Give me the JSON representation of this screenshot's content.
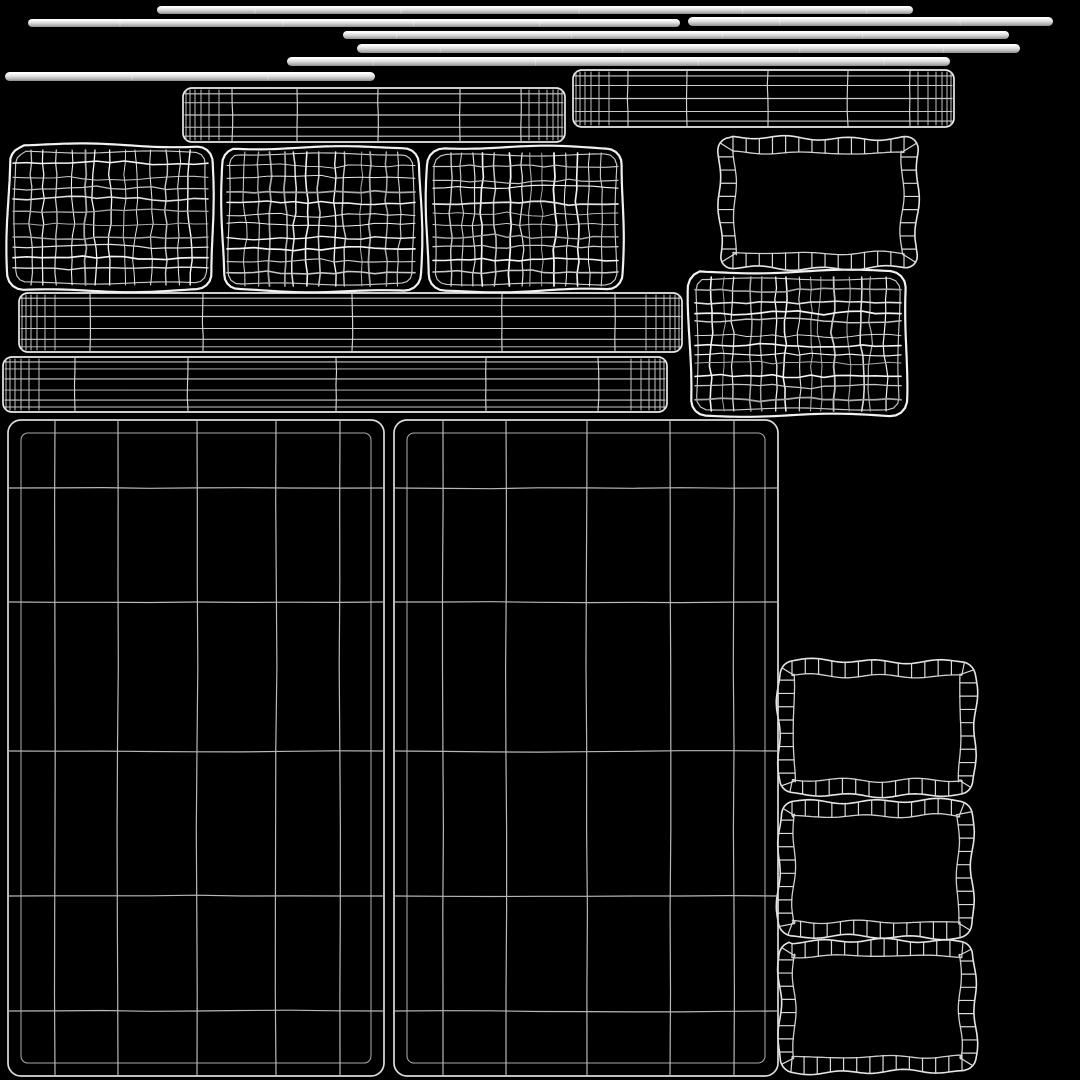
{
  "meta": {
    "description": "UV wireframe layout sheet of upholstered furniture parts rendered as white mesh islands on black",
    "background": "#000000",
    "canvas": {
      "width": 1080,
      "height": 1080
    }
  },
  "palette": {
    "edge": "#f1f1f1",
    "inner_edge": "#c9c9c9",
    "grid_levels": [
      "#a8a8a8",
      "#c6c6c6",
      "#e0e0e0",
      "#f4f4f4"
    ],
    "tube_outline": "#eaeaea",
    "tube_hline": "#c9c9c9",
    "tube_vline": "#d4d4d4",
    "tube_dense": "#c2c2c2",
    "panel_outline": "#dcdcdc",
    "panel_inner": "#a9a9a9",
    "panel_line": "#b8b8b8",
    "ladder_outer": "#e6e6e6",
    "ladder_inner": "#cfcfcf",
    "ladder_rung": "#dadada",
    "rod_top": "#ffffff",
    "rod_mid": "#e6e6e6",
    "rod_low": "#b4b4b4",
    "rod_bottom": "#8d8d8d"
  },
  "islands": [
    {
      "name": "piping-rod-1",
      "type": "rod",
      "x": 157,
      "y": 6,
      "w": 756,
      "h": 8
    },
    {
      "name": "piping-rod-2",
      "type": "rod",
      "x": 28,
      "y": 19,
      "w": 652,
      "h": 8
    },
    {
      "name": "piping-rod-3",
      "type": "rod",
      "x": 688,
      "y": 17,
      "w": 365,
      "h": 9
    },
    {
      "name": "piping-rod-4",
      "type": "rod",
      "x": 343,
      "y": 31,
      "w": 666,
      "h": 8
    },
    {
      "name": "piping-rod-5",
      "type": "rod",
      "x": 357,
      "y": 44,
      "w": 663,
      "h": 9
    },
    {
      "name": "piping-rod-6",
      "type": "rod",
      "x": 287,
      "y": 57,
      "w": 663,
      "h": 9
    },
    {
      "name": "piping-rod-7",
      "type": "rod",
      "x": 5,
      "y": 72,
      "w": 370,
      "h": 9
    },
    {
      "name": "roll-tube-1",
      "type": "tube",
      "x": 573,
      "y": 70,
      "w": 381,
      "h": 57,
      "hLines": 5,
      "vxs": [
        55,
        114,
        195,
        275,
        337
      ]
    },
    {
      "name": "roll-tube-2",
      "type": "tube",
      "x": 183,
      "y": 88,
      "w": 382,
      "h": 54,
      "hLines": 5,
      "vxs": [
        49,
        114,
        195,
        277,
        338
      ]
    },
    {
      "name": "roll-tube-3",
      "type": "tube",
      "x": 19,
      "y": 293,
      "w": 663,
      "h": 59,
      "hLines": 6,
      "vxs": [
        71,
        184,
        333,
        483,
        596
      ]
    },
    {
      "name": "roll-tube-4",
      "type": "tube",
      "x": 3,
      "y": 357,
      "w": 664,
      "h": 55,
      "hLines": 6,
      "vxs": [
        72,
        185,
        333,
        483,
        595
      ]
    },
    {
      "name": "cushion-pillow-1",
      "type": "pillow",
      "x": 8,
      "y": 145,
      "w": 205,
      "h": 145,
      "cols": 14,
      "rows": 11
    },
    {
      "name": "cushion-pillow-2",
      "type": "pillow",
      "x": 222,
      "y": 147,
      "w": 198,
      "h": 144,
      "cols": 14,
      "rows": 11
    },
    {
      "name": "cushion-pillow-3",
      "type": "pillow",
      "x": 428,
      "y": 148,
      "w": 195,
      "h": 143,
      "cols": 15,
      "rows": 11
    },
    {
      "name": "cushion-pillow-4",
      "type": "pillow",
      "x": 690,
      "y": 272,
      "w": 216,
      "h": 144,
      "cols": 16,
      "rows": 12
    },
    {
      "name": "border-ladder-1",
      "type": "ladder",
      "x": 720,
      "y": 138,
      "w": 197,
      "h": 130,
      "band": 15,
      "step": 13
    },
    {
      "name": "border-ladder-2",
      "type": "ladder",
      "x": 779,
      "y": 661,
      "w": 196,
      "h": 134,
      "band": 15,
      "step": 13
    },
    {
      "name": "border-ladder-3",
      "type": "ladder",
      "x": 779,
      "y": 801,
      "w": 194,
      "h": 136,
      "band": 15,
      "step": 13
    },
    {
      "name": "border-ladder-4",
      "type": "ladder",
      "x": 779,
      "y": 941,
      "w": 196,
      "h": 131,
      "band": 15,
      "step": 13
    },
    {
      "name": "base-panel-left",
      "type": "panel",
      "x": 8,
      "y": 420,
      "w": 376,
      "h": 656,
      "inset": 13,
      "vxs": [
        47,
        110,
        189,
        268,
        332
      ],
      "hys": [
        68,
        182,
        331,
        476,
        591
      ]
    },
    {
      "name": "base-panel-right",
      "type": "panel",
      "x": 394,
      "y": 420,
      "w": 384,
      "h": 656,
      "inset": 13,
      "vxs": [
        49,
        112,
        193,
        276,
        340
      ],
      "hys": [
        68,
        182,
        331,
        476,
        591
      ]
    }
  ]
}
